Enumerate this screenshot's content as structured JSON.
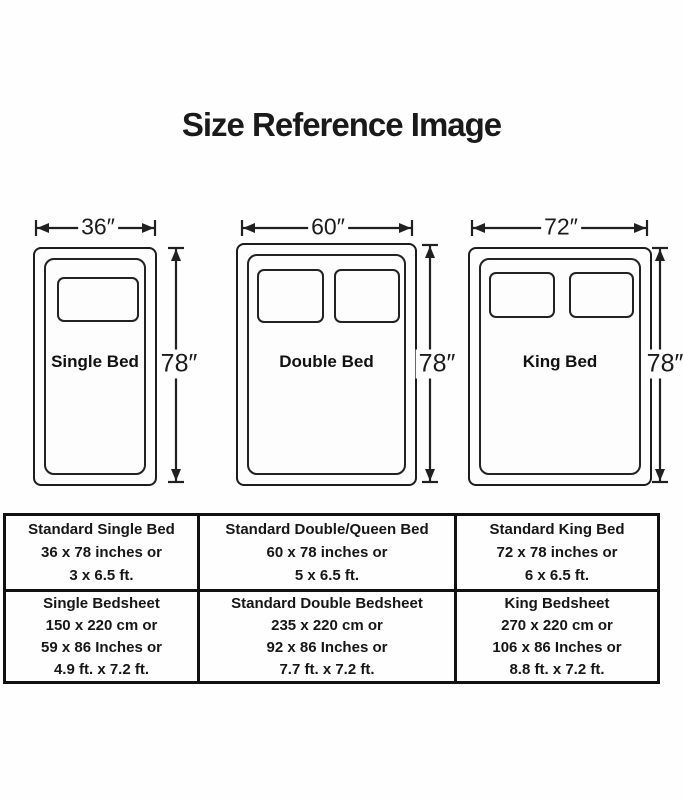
{
  "title": "Size Reference Image",
  "colors": {
    "line": "#202020",
    "text": "#1b1b1b",
    "background": "#fefefe"
  },
  "beds": [
    {
      "name": "Single Bed",
      "width_label": "36″",
      "height_label": "78″",
      "pillows": 1
    },
    {
      "name": "Double Bed",
      "width_label": "60″",
      "height_label": "78″",
      "pillows": 2
    },
    {
      "name": "King Bed",
      "width_label": "72″",
      "height_label": "78″",
      "pillows": 2
    }
  ],
  "table": {
    "rows": [
      {
        "cells": [
          {
            "lines": [
              "Standard Single Bed",
              "36 x 78 inches or",
              "3 x 6.5 ft."
            ]
          },
          {
            "lines": [
              "Standard Double/Queen Bed",
              "60 x 78 inches or",
              "5 x 6.5 ft."
            ]
          },
          {
            "lines": [
              "Standard King Bed",
              "72 x 78 inches or",
              "6 x 6.5 ft."
            ]
          }
        ]
      },
      {
        "cells": [
          {
            "lines": [
              "Single Bedsheet",
              "150 x 220 cm or",
              "59 x 86 Inches or",
              "4.9 ft. x 7.2 ft."
            ]
          },
          {
            "lines": [
              "Standard Double Bedsheet",
              "235 x 220 cm or",
              "92 x 86 Inches or",
              "7.7 ft. x 7.2 ft."
            ]
          },
          {
            "lines": [
              "King Bedsheet",
              "270 x 220 cm or",
              "106 x 86 Inches or",
              "8.8 ft. x 7.2 ft."
            ]
          }
        ]
      }
    ]
  }
}
